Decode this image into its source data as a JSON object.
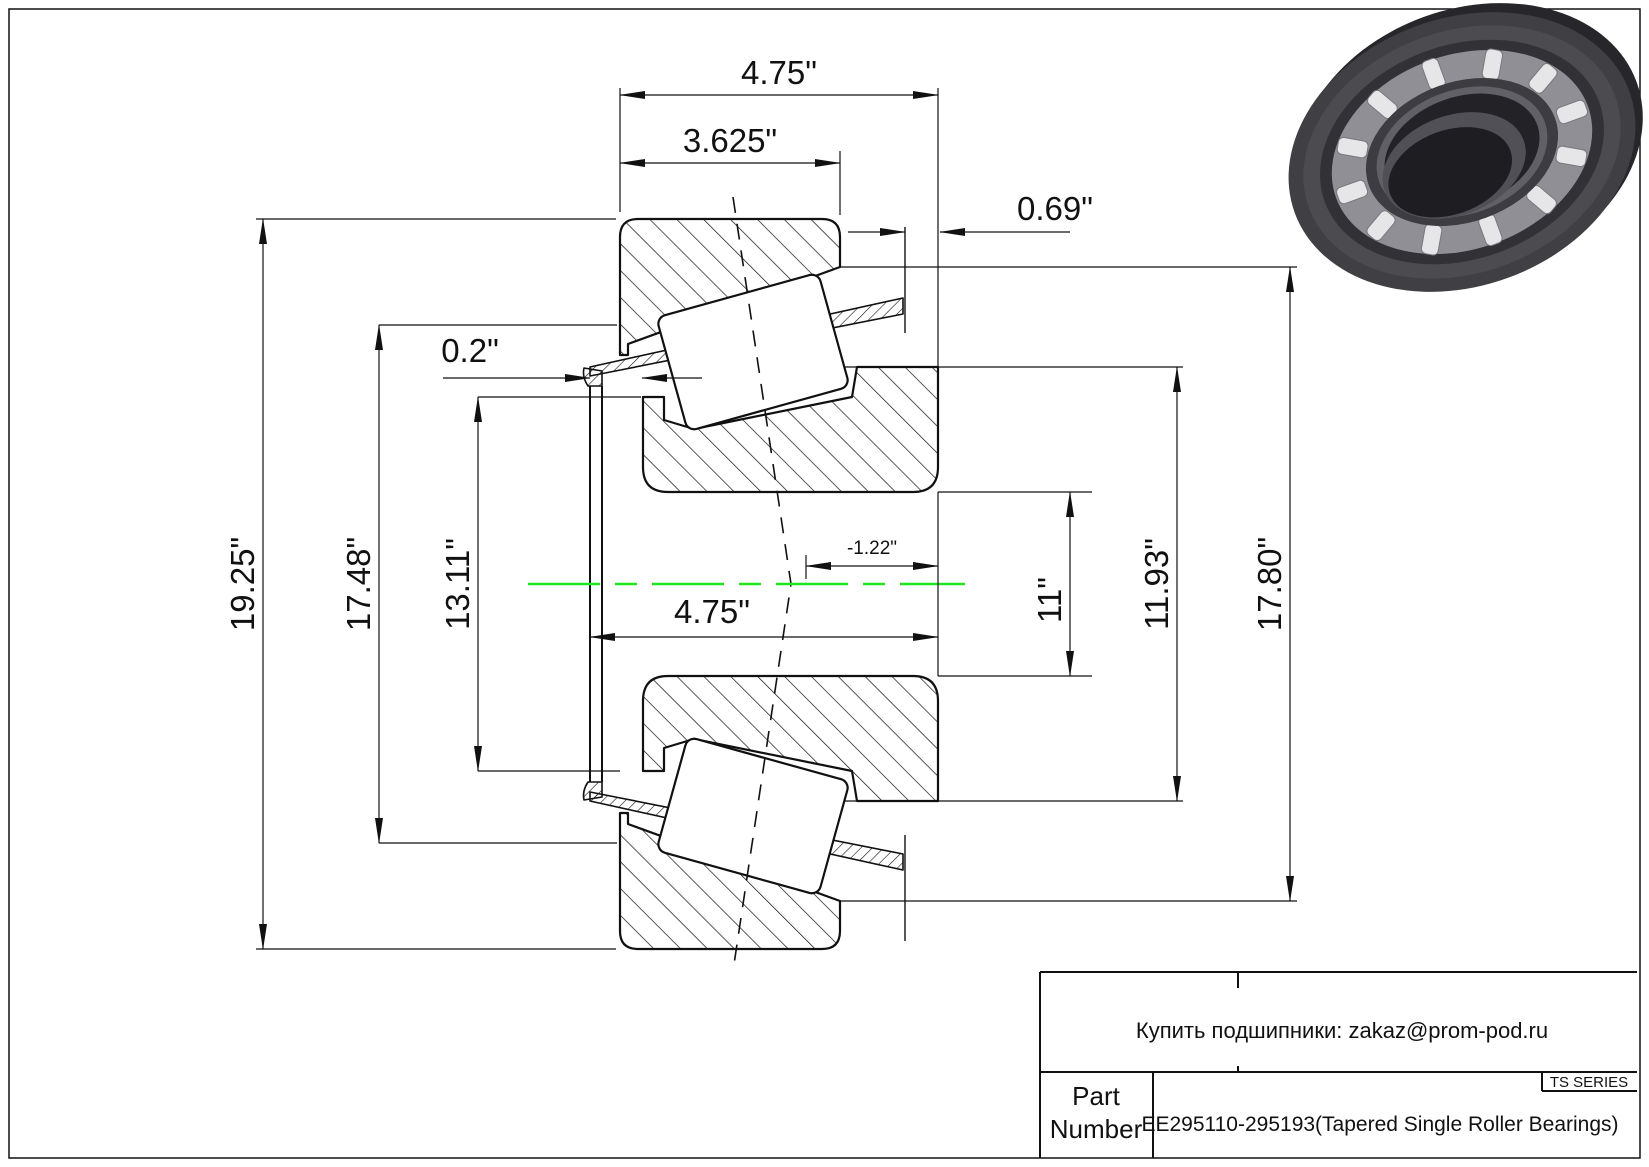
{
  "page": {
    "background": "#ffffff",
    "line_color": "#111111",
    "centerline_color": "#22e522"
  },
  "drawing": {
    "type": "tapered-single-roller-bearing-cross-section",
    "dims": {
      "overall_width": "4.75\"",
      "cup_width": "3.625\"",
      "stand_out": "0.69\"",
      "flange_thickness": "0.2\"",
      "outer_diameter": "19.25\"",
      "cage_outer_diameter": "17.48\"",
      "cone_front_diameter": "13.11\"",
      "bore_width": "4.75\"",
      "apex_offset": "-1.22\"",
      "bore_diameter": "11\"",
      "cone_back_diameter": "11.93\"",
      "cup_back_diameter": "17.80\""
    }
  },
  "title_block": {
    "contact_line": "Купить подшипники: zakaz@prom-pod.ru",
    "series_label": "TS SERIES",
    "part_label_line1": "Part",
    "part_label_line2": "Number",
    "part_number": "EE295110-295193(Tapered Single Roller Bearings)"
  }
}
